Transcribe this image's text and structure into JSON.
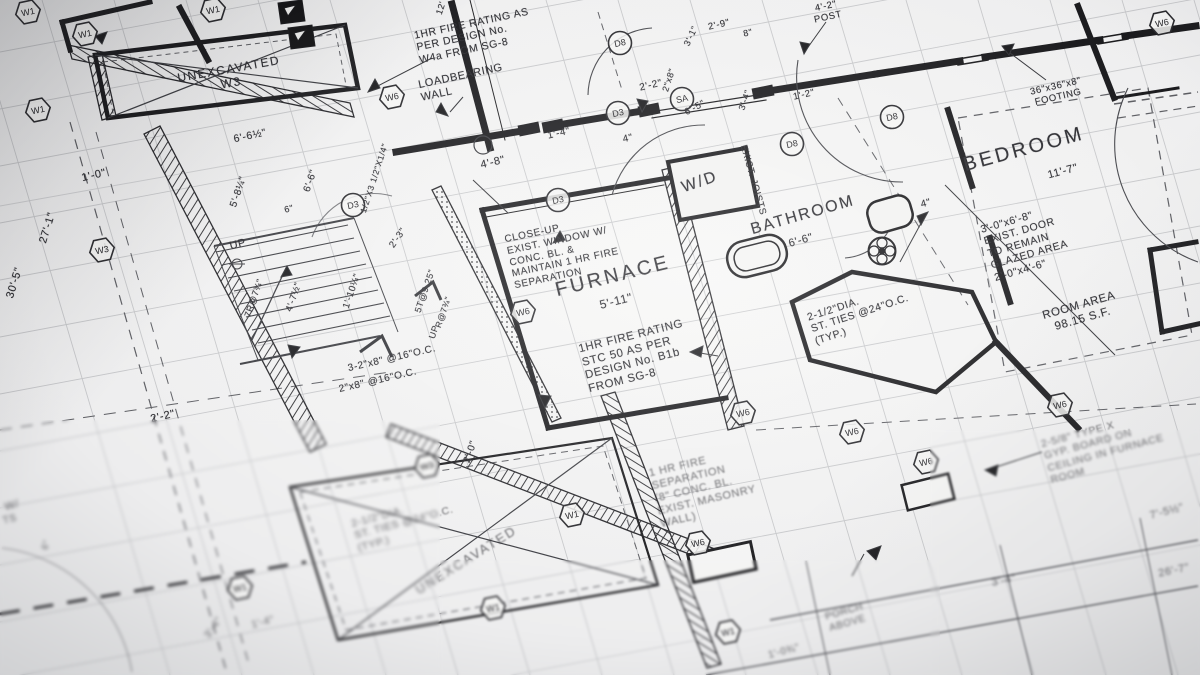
{
  "colors": {
    "paper": "#e9eaeb",
    "ink": "#1b1b1e",
    "grid_gray": "#97999e"
  },
  "labels": [
    {
      "id": "room-unexcavated-top",
      "lines": [
        "UNEXCAVATED",
        "W3"
      ],
      "x": 230,
      "y": 76,
      "rot": -10,
      "size": 12,
      "ls": 1.5
    },
    {
      "id": "dim-6-6-half",
      "lines": [
        "6'-6½\""
      ],
      "x": 250,
      "y": 136,
      "rot": -12,
      "size": 10.5
    },
    {
      "id": "dim-1-0",
      "lines": [
        "1'-0\""
      ],
      "x": 94,
      "y": 176,
      "rot": -13,
      "size": 11
    },
    {
      "id": "dim-27-1",
      "lines": [
        "27'-1\""
      ],
      "x": 48,
      "y": 228,
      "rot": -73,
      "size": 11
    },
    {
      "id": "dim-30-5",
      "lines": [
        "30'-5\""
      ],
      "x": 15,
      "y": 283,
      "rot": -73,
      "size": 11
    },
    {
      "id": "dim-6-6-vert",
      "lines": [
        "6'-6\""
      ],
      "x": 311,
      "y": 181,
      "rot": -71,
      "size": 10
    },
    {
      "id": "dim-5-8-quarter",
      "lines": [
        "5'-8¼\""
      ],
      "x": 239,
      "y": 192,
      "rot": -71,
      "size": 10
    },
    {
      "id": "dim-6in",
      "lines": [
        "6\""
      ],
      "x": 289,
      "y": 209,
      "rot": -14,
      "size": 9
    },
    {
      "id": "label-up",
      "lines": [
        "UP"
      ],
      "x": 238,
      "y": 245,
      "rot": -14,
      "size": 11
    },
    {
      "id": "dim-7r",
      "lines": [
        "7R@7¾\""
      ],
      "x": 254,
      "y": 298,
      "rot": -71,
      "size": 9
    },
    {
      "id": "dim-4-7-half",
      "lines": [
        "4'-7½\""
      ],
      "x": 294,
      "y": 297,
      "rot": -71,
      "size": 9.5
    },
    {
      "id": "dim-1-10-quarter",
      "lines": [
        "1'-10¼\""
      ],
      "x": 352,
      "y": 291,
      "rot": -71,
      "size": 9.5
    },
    {
      "id": "dim-5t",
      "lines": [
        "5T@9.25\""
      ],
      "x": 425,
      "y": 291,
      "rot": -71,
      "size": 9
    },
    {
      "id": "label-up-2",
      "lines": [
        "UP"
      ],
      "x": 434,
      "y": 332,
      "rot": -71,
      "size": 9
    },
    {
      "id": "dim-r-7",
      "lines": [
        "R@7¾\""
      ],
      "x": 443,
      "y": 312,
      "rot": -71,
      "size": 8.5
    },
    {
      "id": "dim-2-3",
      "lines": [
        "2'-3\""
      ],
      "x": 398,
      "y": 238,
      "rot": -55,
      "size": 9.5
    },
    {
      "id": "dim-steel-angle",
      "lines": [
        "1/2\"X3 1/2\"X1/4\""
      ],
      "x": 374,
      "y": 178,
      "rot": -72,
      "size": 8.5
    },
    {
      "id": "note-beam",
      "lines": [
        "3-2\"x8\" @16\"O.C."
      ],
      "x": 392,
      "y": 359,
      "rot": -13,
      "size": 10
    },
    {
      "id": "note-joists",
      "lines": [
        "2\"x8\" @16\"O.C."
      ],
      "x": 378,
      "y": 381,
      "rot": -13,
      "size": 10
    },
    {
      "id": "dim-2-2-left",
      "lines": [
        "2'-2\""
      ],
      "x": 163,
      "y": 417,
      "rot": -13,
      "size": 11
    },
    {
      "id": "dim-2-0",
      "lines": [
        "2'-0\""
      ],
      "x": 471,
      "y": 452,
      "rot": -71,
      "size": 10
    },
    {
      "id": "note-fire-rating-w4a",
      "lines": [
        "1HR FIRE RATING AS",
        "PER DESIGN No.",
        "W4a FROM SG-8"
      ],
      "x": 474,
      "y": 36,
      "rot": -12,
      "size": 10.5,
      "left": true
    },
    {
      "id": "note-loadbearing",
      "lines": [
        "LOADBEARING",
        "WALL"
      ],
      "x": 462,
      "y": 83,
      "rot": -12,
      "size": 11,
      "left": true
    },
    {
      "id": "dim-12",
      "lines": [
        "12'"
      ],
      "x": 441,
      "y": 8,
      "rot": -72,
      "size": 9
    },
    {
      "id": "dim-2-2-top",
      "lines": [
        "2'-2\""
      ],
      "x": 651,
      "y": 86,
      "rot": -13,
      "size": 10
    },
    {
      "id": "dim-1-4-top",
      "lines": [
        "1'-4\""
      ],
      "x": 559,
      "y": 134,
      "rot": -13,
      "size": 10
    },
    {
      "id": "dim-4-top",
      "lines": [
        "4\""
      ],
      "x": 628,
      "y": 139,
      "rot": -13,
      "size": 10
    },
    {
      "id": "dim-4-8",
      "lines": [
        "4'-8\""
      ],
      "x": 493,
      "y": 163,
      "rot": -13,
      "size": 11
    },
    {
      "id": "note-closeup-window",
      "lines": [
        "CLOSE-UP",
        "EXIST. WINDOW W/",
        "CONC. BL. &",
        "MAINTAIN 1 HR FIRE",
        "SEPARATION"
      ],
      "x": 563,
      "y": 252,
      "rot": -12,
      "size": 10,
      "left": true
    },
    {
      "id": "room-furnace",
      "lines": [
        "FURNACE"
      ],
      "x": 613,
      "y": 277,
      "rot": -14,
      "size": 20,
      "ls": 3
    },
    {
      "id": "dim-furnace",
      "lines": [
        "5'-11\""
      ],
      "x": 616,
      "y": 301,
      "rot": -14,
      "size": 12
    },
    {
      "id": "note-fire-rating-b1b",
      "lines": [
        "1HR FIRE RATING",
        "STC 50 AS PER",
        "DESIGN No. B1b",
        "FROM SG-8"
      ],
      "x": 636,
      "y": 357,
      "rot": -14,
      "size": 11.5,
      "left": true
    },
    {
      "id": "room-wd",
      "lines": [
        "W/D"
      ],
      "x": 700,
      "y": 183,
      "rot": -19,
      "size": 16,
      "ls": 2
    },
    {
      "id": "label-exist-joists",
      "lines": [
        "EXIST. JOISTS"
      ],
      "x": 753,
      "y": 180,
      "rot": 74,
      "size": 9.5
    },
    {
      "id": "room-bathroom",
      "lines": [
        "BATHROOM"
      ],
      "x": 803,
      "y": 216,
      "rot": -16,
      "size": 16,
      "ls": 2
    },
    {
      "id": "dim-bathroom",
      "lines": [
        "6'-6\""
      ],
      "x": 801,
      "y": 241,
      "rot": -16,
      "size": 11
    },
    {
      "id": "note-st-ties-right",
      "lines": [
        "2-1/2\"DIA.",
        "ST. TIES @24\"O.C.",
        "(TYP.)"
      ],
      "x": 860,
      "y": 314,
      "rot": -18,
      "size": 10.5,
      "left": true
    },
    {
      "id": "dim-4-bath",
      "lines": [
        "4\""
      ],
      "x": 926,
      "y": 204,
      "rot": -15,
      "size": 10
    },
    {
      "id": "dim-2-9",
      "lines": [
        "2'-9\""
      ],
      "x": 719,
      "y": 25,
      "rot": -13,
      "size": 9.5
    },
    {
      "id": "dim-3-1",
      "lines": [
        "3'-1\""
      ],
      "x": 691,
      "y": 36,
      "rot": -65,
      "size": 9
    },
    {
      "id": "dim-8in",
      "lines": [
        "8\""
      ],
      "x": 748,
      "y": 33,
      "rot": -13,
      "size": 9
    },
    {
      "id": "dim-2x8",
      "lines": [
        "2\"x8\""
      ],
      "x": 669,
      "y": 80,
      "rot": -72,
      "size": 9
    },
    {
      "id": "dim-6-5",
      "lines": [
        "6'-5\""
      ],
      "x": 695,
      "y": 108,
      "rot": -28,
      "size": 9.5
    },
    {
      "id": "dim-3-4-top",
      "lines": [
        "3'-4\""
      ],
      "x": 745,
      "y": 100,
      "rot": -71,
      "size": 9
    },
    {
      "id": "dim-1-2",
      "lines": [
        "1'-2\""
      ],
      "x": 804,
      "y": 95,
      "rot": -13,
      "size": 9.5
    },
    {
      "id": "note-post",
      "lines": [
        "4'-2\"",
        "POST"
      ],
      "x": 827,
      "y": 12,
      "rot": -12,
      "size": 9.5
    },
    {
      "id": "note-footing",
      "lines": [
        "36\"x36\"x8\"",
        "FOOTING"
      ],
      "x": 1057,
      "y": 92,
      "rot": -13,
      "size": 9.5
    },
    {
      "id": "room-bedroom",
      "lines": [
        "BEDROOM"
      ],
      "x": 1024,
      "y": 150,
      "rot": -15,
      "size": 20,
      "ls": 3
    },
    {
      "id": "dim-bedroom",
      "lines": [
        "11'-7\""
      ],
      "x": 1063,
      "y": 172,
      "rot": -15,
      "size": 11
    },
    {
      "id": "note-exist-door",
      "lines": [
        "3'-0\"x6'-8\"",
        "EXIST. DOOR",
        "TO REMAIN",
        "GLAZED AREA",
        "2'-0\"x4'-6\""
      ],
      "x": 1026,
      "y": 243,
      "rot": -16,
      "size": 10.5,
      "left": true
    },
    {
      "id": "note-room-area",
      "lines": [
        "ROOM AREA",
        "98.15 S.F."
      ],
      "x": 1081,
      "y": 313,
      "rot": -16,
      "size": 11.5
    },
    {
      "id": "note-gyp-board",
      "lines": [
        "2-5/8\" TYPE X",
        "GYP. BOARD ON",
        "CEILING IN FURNACE",
        "ROOM"
      ],
      "x": 1104,
      "y": 447,
      "rot": -15,
      "size": 10.5,
      "left": true,
      "soft": true
    },
    {
      "id": "note-fire-separation",
      "lines": [
        "1 HR FIRE",
        "SEPARATION",
        "(8\" CONC. BL.",
        "EXIST. MASONRY",
        "WALL)"
      ],
      "x": 704,
      "y": 488,
      "rot": -13,
      "size": 11,
      "left": true,
      "soft": true
    },
    {
      "id": "note-st-ties-left",
      "lines": [
        "2-1/2\"DIA.",
        "ST. TIES @24\"O.C.",
        "(TYP.)"
      ],
      "x": 404,
      "y": 523,
      "rot": -15,
      "size": 10.5,
      "left": true,
      "soft": true
    },
    {
      "id": "room-unexcavated-bottom",
      "lines": [
        "UNEXCAVATED"
      ],
      "x": 466,
      "y": 560,
      "rot": -32,
      "size": 13,
      "ls": 2,
      "soft": true
    },
    {
      "id": "note-porch-above",
      "lines": [
        "PORCH",
        "ABOVE"
      ],
      "x": 846,
      "y": 618,
      "rot": -16,
      "size": 10,
      "soft": true
    },
    {
      "id": "dim-7-5-half",
      "lines": [
        "7'-5½\""
      ],
      "x": 1167,
      "y": 512,
      "rot": -15,
      "size": 11,
      "soft": true
    },
    {
      "id": "dim-3-4-bottom",
      "lines": [
        "3'-4\""
      ],
      "x": 1004,
      "y": 581,
      "rot": -12,
      "size": 11,
      "soft": true
    },
    {
      "id": "dim-26-7",
      "lines": [
        "26'-7\""
      ],
      "x": 1174,
      "y": 571,
      "rot": -12,
      "size": 11,
      "soft": true
    },
    {
      "id": "dim-1-0-three-quarter",
      "lines": [
        "1'-0¾\""
      ],
      "x": 784,
      "y": 652,
      "rot": -15,
      "size": 10,
      "soft": true
    },
    {
      "id": "dim-1-4-bottom",
      "lines": [
        "1'-4\""
      ],
      "x": 263,
      "y": 623,
      "rot": -15,
      "size": 10,
      "soft": true
    },
    {
      "id": "dim-3-4-bl",
      "lines": [
        "3'-4\""
      ],
      "x": 214,
      "y": 628,
      "rot": -55,
      "size": 10,
      "soft": true
    },
    {
      "id": "edge-label-w",
      "lines": [
        "W/"
      ],
      "x": 12,
      "y": 506,
      "rot": -14,
      "size": 11,
      "soft": true
    },
    {
      "id": "edge-label-ts",
      "lines": [
        "TS"
      ],
      "x": 10,
      "y": 520,
      "rot": -14,
      "size": 10,
      "soft": true
    },
    {
      "id": "dim-6-bl",
      "lines": [
        "6\""
      ],
      "x": 46,
      "y": 545,
      "rot": -71,
      "size": 9,
      "soft": true
    }
  ],
  "wall_symbols": [
    {
      "label": "W1",
      "x": 28,
      "y": 12
    },
    {
      "label": "W1",
      "x": 85,
      "y": 34
    },
    {
      "label": "W1",
      "x": 213,
      "y": 10
    },
    {
      "label": "W1",
      "x": 38,
      "y": 110
    },
    {
      "label": "W3",
      "x": 102,
      "y": 250
    },
    {
      "label": "W6",
      "x": 392,
      "y": 97
    },
    {
      "label": "W6",
      "x": 523,
      "y": 312
    },
    {
      "label": "W3",
      "x": 427,
      "y": 466
    },
    {
      "label": "W1",
      "x": 240,
      "y": 588
    },
    {
      "label": "W1",
      "x": 493,
      "y": 608
    },
    {
      "label": "W6",
      "x": 743,
      "y": 413
    },
    {
      "label": "W1",
      "x": 572,
      "y": 515
    },
    {
      "label": "W6",
      "x": 698,
      "y": 543
    },
    {
      "label": "W1",
      "x": 728,
      "y": 632
    },
    {
      "label": "W6",
      "x": 852,
      "y": 432
    },
    {
      "label": "W6",
      "x": 926,
      "y": 462
    },
    {
      "label": "W6",
      "x": 1060,
      "y": 405
    },
    {
      "label": "W6",
      "x": 1162,
      "y": 23
    }
  ],
  "door_symbols": [
    {
      "label": "D8",
      "x": 620,
      "y": 43
    },
    {
      "label": "D3",
      "x": 618,
      "y": 113
    },
    {
      "label": "SA",
      "x": 682,
      "y": 99
    },
    {
      "label": "D3",
      "x": 558,
      "y": 200
    },
    {
      "label": "D3",
      "x": 353,
      "y": 205
    },
    {
      "label": "D8",
      "x": 792,
      "y": 144
    },
    {
      "label": "D8",
      "x": 892,
      "y": 117
    }
  ]
}
